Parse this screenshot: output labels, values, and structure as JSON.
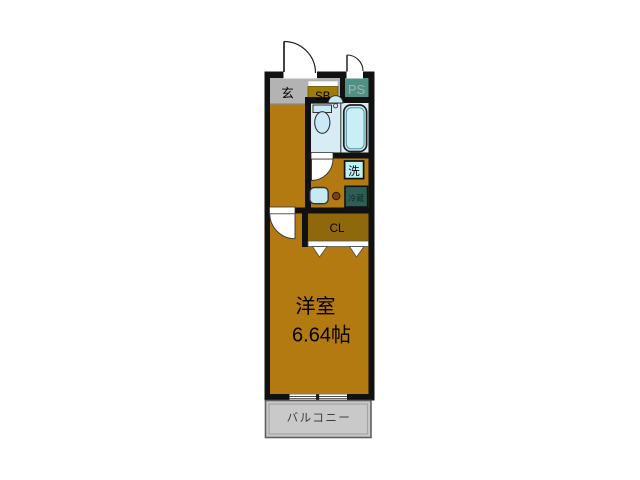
{
  "floorplan": {
    "rooms": {
      "entrance": {
        "label": "玄"
      },
      "shoe_box": {
        "label": "SB"
      },
      "pipe_space": {
        "label": "PS"
      },
      "washer": {
        "label": "洗"
      },
      "refrigerator": {
        "label": "冷蔵"
      },
      "closet": {
        "label": "CL"
      },
      "main_room": {
        "name": "洋室",
        "size": "6.64帖"
      },
      "balcony": {
        "label": "バルコニー"
      }
    },
    "colors": {
      "wall": "#111111",
      "wood_floor": "#b27a10",
      "closet_floor": "#8e680a",
      "entrance_floor": "#b3b3b3",
      "shoe_box": "#9c7e04",
      "pipe_space": "#4f9184",
      "bath_floor": "#d7ecf5",
      "fixture_fill": "#c9eaf4",
      "washer_box": "#bdf2f4",
      "refrigerator_box": "#2e5e56",
      "balcony_floor": "#c9c9c9",
      "ps_text": "#a4b2ae",
      "fridge_text": "#0d2b26",
      "balcony_text": "#3d3d3d"
    }
  }
}
